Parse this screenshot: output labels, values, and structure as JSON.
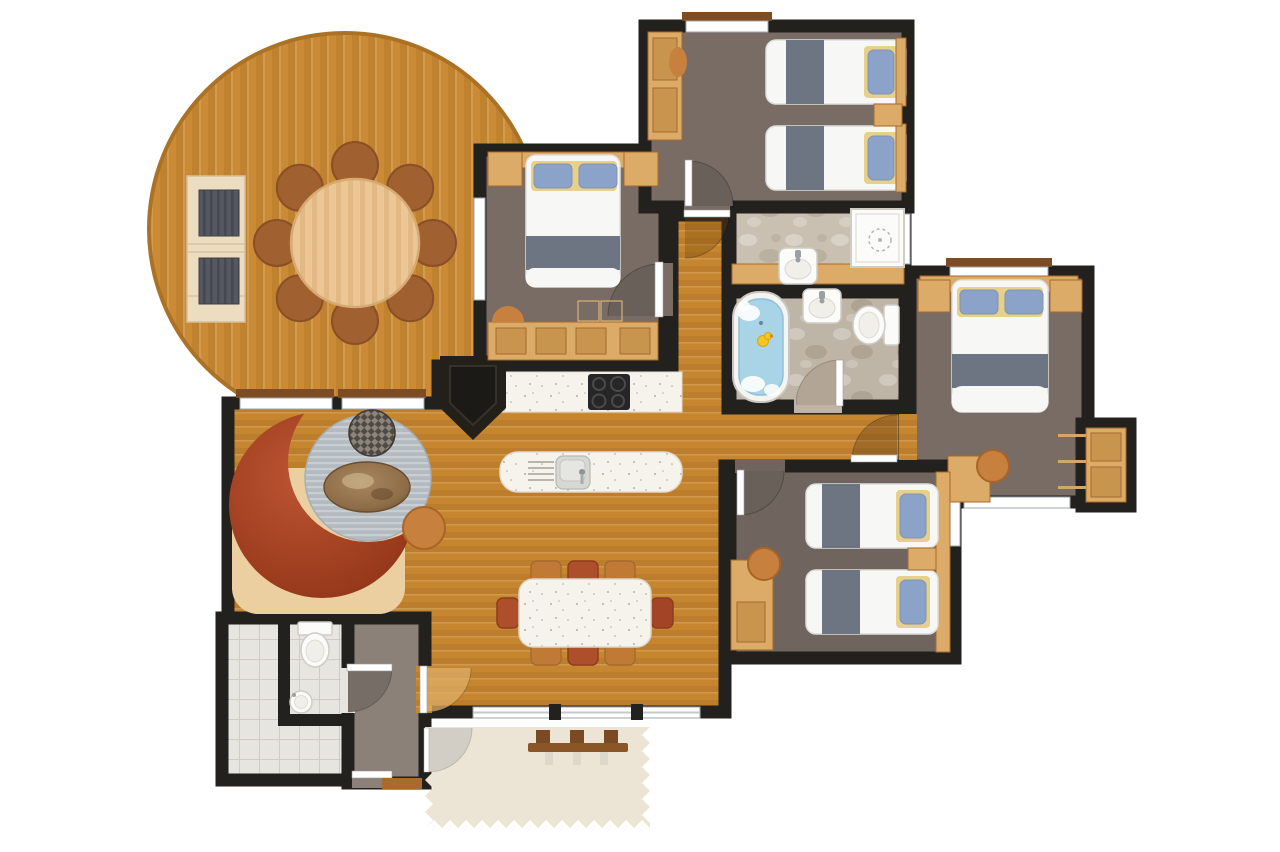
{
  "meta": {
    "kind": "holiday-lodge-floor-plan",
    "visible_text": "",
    "orientation": "top-down"
  },
  "palette": {
    "wall": "#23211e",
    "deck-base": "#cb8b36",
    "deck-stripe": "#b87a29",
    "deck-edge": "#ab7226",
    "wood-base": "#c6862f",
    "wood-stripe": "#b2742a",
    "bedroom-floor": "#786c65",
    "bedroom-floor-dark": "#6f655e",
    "bath-floor": "#cac0b2",
    "bath-floor-dark": "#bfb5a6",
    "tile-floor": "#e7e5e0",
    "tile-line": "#cfccc5",
    "hall-floor": "#8b8179",
    "tan": "#dcab67",
    "tan-dark": "#c8954f",
    "tan-deep": "#a86a2e",
    "counter": "#f6f3ec",
    "white-fixture": "#fbfbf9",
    "fixture-line": "#cfccc6",
    "bed-white": "#f7f7f5",
    "blanket-gray": "#6d7582",
    "pillow-blue": "#8ca3c9",
    "pillow-trim": "#e7d08a",
    "sofa-red": "#bd5433",
    "sofa-red-dark": "#8e3315",
    "rug-gray": "#b3bac0",
    "rug-stripe": "#c9ced2",
    "rug-tan": "#eccfa0",
    "pouf-orange": "#c8803f",
    "check-dark": "#4f4a43",
    "check-light": "#8d857b",
    "table-marble": "#8d6c48",
    "water-blue": "#a9d3e6",
    "duck-yellow": "#f3c623",
    "window-white": "#ffffff",
    "sill-brown": "#7d4c22",
    "mat-cream": "#ece5d6",
    "chair-orange": "#c07a36",
    "chair-red": "#ad4f2b",
    "hob-black": "#262626",
    "arc-dark": "#6a605a",
    "arc-bath": "#b2a595",
    "arc-hall": "#766d66",
    "arc-outside": "#d2cdc5"
  },
  "counts": {
    "bedrooms": 4,
    "double_beds": 2,
    "single_beds": 4,
    "deck_chairs": 8,
    "dining_chairs": 8,
    "bathrooms": 3
  },
  "rooms": [
    {
      "id": "deck-terrace",
      "label": "Round deck terrace",
      "furniture": [
        "round table",
        "8 deck chairs",
        "double lounger"
      ]
    },
    {
      "id": "living-room",
      "label": "Living room",
      "furniture": [
        "curved sofa",
        "round rug",
        "coffee table",
        "2 poufs",
        "fireplace"
      ]
    },
    {
      "id": "kitchen",
      "label": "Kitchen",
      "furniture": [
        "worktop",
        "hob",
        "island with sink"
      ]
    },
    {
      "id": "dining-area",
      "label": "Dining area",
      "furniture": [
        "table",
        "8 chairs"
      ]
    },
    {
      "id": "bedroom-top-center",
      "label": "Double bedroom 1",
      "furniture": [
        "double bed",
        "2 nightstands",
        "storage bench",
        "stool"
      ]
    },
    {
      "id": "bedroom-top-right",
      "label": "Twin bedroom 1",
      "furniture": [
        "2 single beds",
        "wardrobe",
        "nightstand"
      ]
    },
    {
      "id": "bedroom-right",
      "label": "Double bedroom 2",
      "furniture": [
        "double bed",
        "2 nightstands",
        "desk",
        "chair",
        "wardrobe"
      ]
    },
    {
      "id": "bedroom-bottom-right",
      "label": "Twin bedroom 2",
      "furniture": [
        "2 single beds",
        "desk",
        "chair",
        "nightstand"
      ]
    },
    {
      "id": "shower-room",
      "label": "Shower room",
      "furniture": [
        "shower",
        "washbasin",
        "vanity"
      ]
    },
    {
      "id": "family-bathroom",
      "label": "Family bathroom",
      "furniture": [
        "bathtub",
        "washbasin",
        "toilet"
      ]
    },
    {
      "id": "wc",
      "label": "WC / utility",
      "furniture": [
        "toilet",
        "round washbasin"
      ]
    },
    {
      "id": "entrance-hall",
      "label": "Entrance hall",
      "furniture": []
    },
    {
      "id": "hallway",
      "label": "Inner hallway",
      "furniture": []
    },
    {
      "id": "corridor",
      "label": "Corridor",
      "furniture": []
    },
    {
      "id": "porch",
      "label": "Entrance porch",
      "furniture": [
        "doormat",
        "bench"
      ]
    }
  ]
}
